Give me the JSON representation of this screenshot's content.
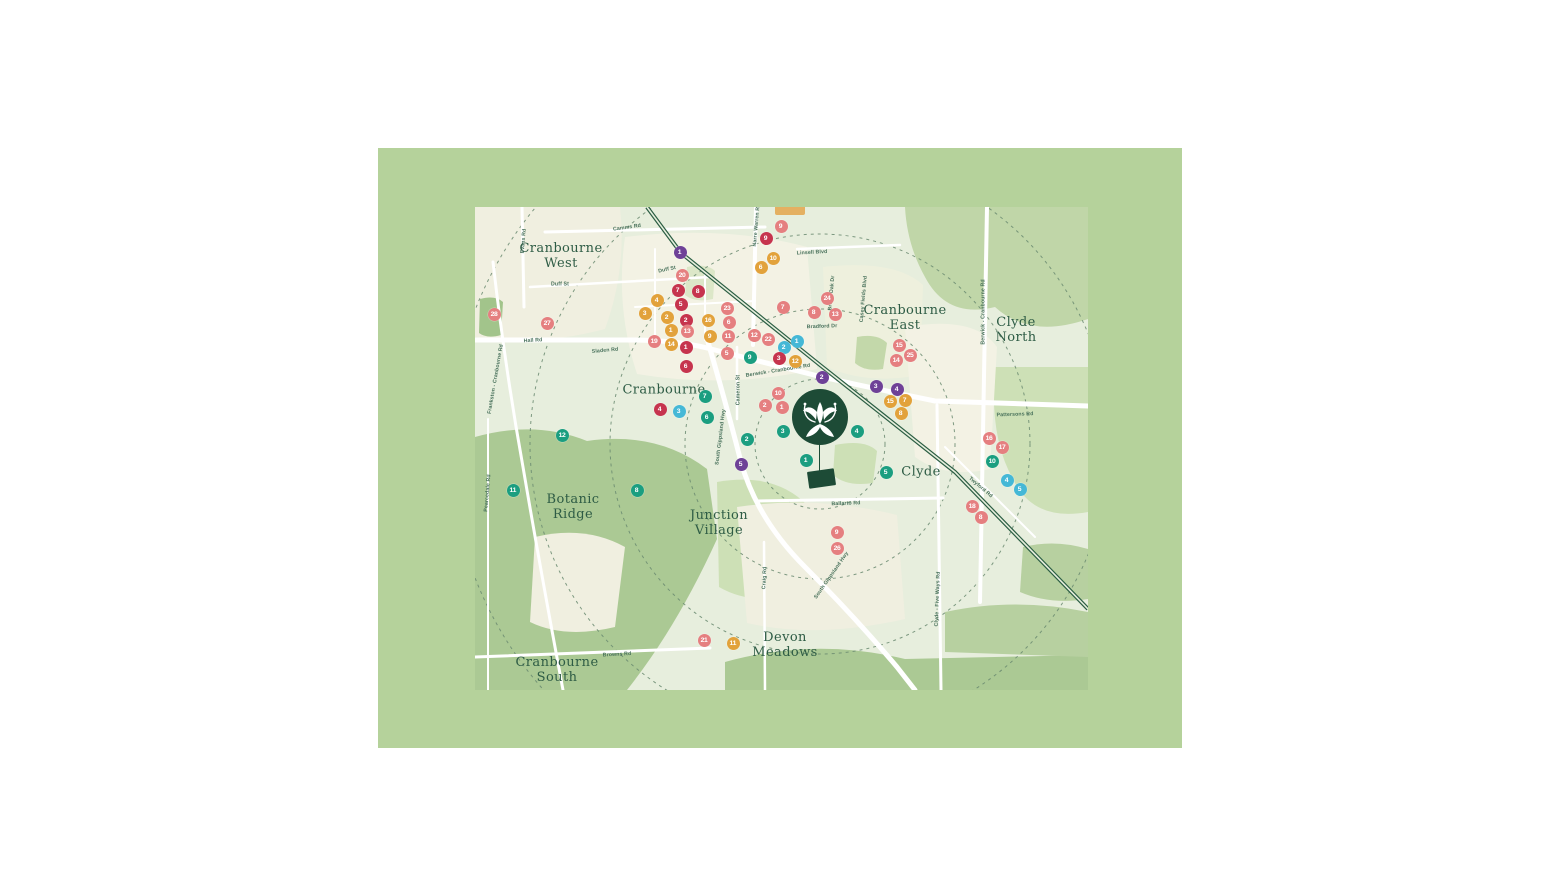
{
  "map": {
    "palette": {
      "band_green": "#b5d29b",
      "map_base": "#e7eedd",
      "urban_cream": "#f3f2e4",
      "sage": "#c9dcb4",
      "park_green": "#abc994",
      "road_white": "#ffffff",
      "railway_green": "#2b5e43",
      "ring_dash": "#6a8a70",
      "label_green": "#2e5c45",
      "estate_dark_green": "#1d4b36",
      "marker_red": "#c6344e",
      "marker_salmon": "#e57f80",
      "marker_orange": "#e2a23b",
      "marker_teal": "#1b9e80",
      "marker_cyan": "#45b8d6",
      "marker_purple": "#6e4197"
    },
    "suburbs": [
      {
        "label": "Cranbourne\nWest",
        "x": 86,
        "y": 50
      },
      {
        "label": "Cranbourne",
        "x": 189,
        "y": 184
      },
      {
        "label": "Cranbourne\nEast",
        "x": 430,
        "y": 112
      },
      {
        "label": "Clyde\nNorth",
        "x": 541,
        "y": 124
      },
      {
        "label": "Botanic\nRidge",
        "x": 98,
        "y": 301
      },
      {
        "label": "Junction\nVillage",
        "x": 244,
        "y": 317
      },
      {
        "label": "Devon\nMeadows",
        "x": 310,
        "y": 439
      },
      {
        "label": "Cranbourne\nSouth",
        "x": 82,
        "y": 464
      },
      {
        "label": "Clyde",
        "x": 446,
        "y": 266
      }
    ],
    "road_labels": [
      {
        "name": "Camms Rd",
        "x": 152,
        "y": 20,
        "rot": -8
      },
      {
        "name": "Duff St",
        "x": 85,
        "y": 77,
        "rot": 0
      },
      {
        "name": "Duff St",
        "x": 192,
        "y": 62,
        "rot": -12
      },
      {
        "name": "Hall Rd",
        "x": 58,
        "y": 133,
        "rot": -3
      },
      {
        "name": "Sladen Rd",
        "x": 130,
        "y": 143,
        "rot": -5
      },
      {
        "name": "Berwick - Cranbourne Rd",
        "x": 303,
        "y": 163,
        "rot": -9
      },
      {
        "name": "Cameron St",
        "x": 263,
        "y": 183,
        "rot": -90
      },
      {
        "name": "South Gippsland Hwy",
        "x": 245,
        "y": 230,
        "rot": -83
      },
      {
        "name": "South Gippsland Hwy",
        "x": 356,
        "y": 368,
        "rot": -55
      },
      {
        "name": "Ballarto Rd",
        "x": 371,
        "y": 296,
        "rot": -2
      },
      {
        "name": "Craig Rd",
        "x": 289,
        "y": 371,
        "rot": -87
      },
      {
        "name": "Browns Rd",
        "x": 142,
        "y": 447,
        "rot": -3
      },
      {
        "name": "Pattersons Rd",
        "x": 540,
        "y": 207,
        "rot": -2
      },
      {
        "name": "Twyford Rd",
        "x": 506,
        "y": 280,
        "rot": 40
      },
      {
        "name": "Pearcedale Rd",
        "x": 12,
        "y": 286,
        "rot": -85
      },
      {
        "name": "Frankston - Cranbourne Rd",
        "x": 20,
        "y": 172,
        "rot": -80
      },
      {
        "name": "Evans Rd",
        "x": 48,
        "y": 34,
        "rot": -85
      },
      {
        "name": "Narre Warren Rd",
        "x": 281,
        "y": 18,
        "rot": -85
      },
      {
        "name": "Linsell Blvd",
        "x": 337,
        "y": 45,
        "rot": -3
      },
      {
        "name": "Broad Oak Dr",
        "x": 356,
        "y": 86,
        "rot": -85
      },
      {
        "name": "Casey Fields Blvd",
        "x": 388,
        "y": 92,
        "rot": -85
      },
      {
        "name": "Bradford Dr",
        "x": 347,
        "y": 119,
        "rot": -2
      },
      {
        "name": "Clyde - Five Ways Rd",
        "x": 462,
        "y": 392,
        "rot": -88
      },
      {
        "name": "Berwick - Cranbourne Rd",
        "x": 508,
        "y": 105,
        "rot": -90
      }
    ],
    "markers": {
      "items": [
        {
          "n": "1",
          "color": "marker_purple",
          "x": 205,
          "y": 45
        },
        {
          "n": "2",
          "color": "marker_purple",
          "x": 347,
          "y": 170
        },
        {
          "n": "3",
          "color": "marker_purple",
          "x": 401,
          "y": 179
        },
        {
          "n": "4",
          "color": "marker_purple",
          "x": 422,
          "y": 182
        },
        {
          "n": "5",
          "color": "marker_purple",
          "x": 266,
          "y": 257
        },
        {
          "n": "1",
          "color": "marker_cyan",
          "x": 322,
          "y": 134
        },
        {
          "n": "2",
          "color": "marker_cyan",
          "x": 309,
          "y": 140
        },
        {
          "n": "3",
          "color": "marker_cyan",
          "x": 204,
          "y": 204
        },
        {
          "n": "4",
          "color": "marker_cyan",
          "x": 532,
          "y": 273
        },
        {
          "n": "5",
          "color": "marker_cyan",
          "x": 545,
          "y": 282
        },
        {
          "n": "1",
          "color": "marker_teal",
          "x": 331,
          "y": 253
        },
        {
          "n": "2",
          "color": "marker_teal",
          "x": 272,
          "y": 232
        },
        {
          "n": "3",
          "color": "marker_teal",
          "x": 308,
          "y": 224
        },
        {
          "n": "4",
          "color": "marker_teal",
          "x": 382,
          "y": 224
        },
        {
          "n": "5",
          "color": "marker_teal",
          "x": 411,
          "y": 265
        },
        {
          "n": "6",
          "color": "marker_teal",
          "x": 232,
          "y": 210
        },
        {
          "n": "7",
          "color": "marker_teal",
          "x": 230,
          "y": 189
        },
        {
          "n": "8",
          "color": "marker_teal",
          "x": 162,
          "y": 283
        },
        {
          "n": "9",
          "color": "marker_teal",
          "x": 275,
          "y": 150
        },
        {
          "n": "10",
          "color": "marker_teal",
          "x": 517,
          "y": 254
        },
        {
          "n": "11",
          "color": "marker_teal",
          "x": 38,
          "y": 283
        },
        {
          "n": "12",
          "color": "marker_teal",
          "x": 87,
          "y": 228
        },
        {
          "n": "1",
          "color": "marker_red",
          "x": 211,
          "y": 140
        },
        {
          "n": "2",
          "color": "marker_red",
          "x": 211,
          "y": 113
        },
        {
          "n": "3",
          "color": "marker_red",
          "x": 304,
          "y": 151
        },
        {
          "n": "4",
          "color": "marker_red",
          "x": 185,
          "y": 202
        },
        {
          "n": "5",
          "color": "marker_red",
          "x": 206,
          "y": 97
        },
        {
          "n": "6",
          "color": "marker_red",
          "x": 211,
          "y": 159
        },
        {
          "n": "7",
          "color": "marker_red",
          "x": 203,
          "y": 83
        },
        {
          "n": "8",
          "color": "marker_red",
          "x": 223,
          "y": 84
        },
        {
          "n": "9",
          "color": "marker_red",
          "x": 291,
          "y": 31
        },
        {
          "n": "1",
          "color": "marker_orange",
          "x": 196,
          "y": 123
        },
        {
          "n": "2",
          "color": "marker_orange",
          "x": 192,
          "y": 110
        },
        {
          "n": "3",
          "color": "marker_orange",
          "x": 170,
          "y": 106
        },
        {
          "n": "4",
          "color": "marker_orange",
          "x": 182,
          "y": 93
        },
        {
          "n": "6",
          "color": "marker_orange",
          "x": 286,
          "y": 60
        },
        {
          "n": "7",
          "color": "marker_orange",
          "x": 430,
          "y": 193
        },
        {
          "n": "8",
          "color": "marker_orange",
          "x": 426,
          "y": 206
        },
        {
          "n": "9",
          "color": "marker_orange",
          "x": 235,
          "y": 129
        },
        {
          "n": "10",
          "color": "marker_orange",
          "x": 298,
          "y": 51
        },
        {
          "n": "11",
          "color": "marker_orange",
          "x": 258,
          "y": 436
        },
        {
          "n": "12",
          "color": "marker_orange",
          "x": 320,
          "y": 154
        },
        {
          "n": "14",
          "color": "marker_orange",
          "x": 196,
          "y": 137
        },
        {
          "n": "15",
          "color": "marker_orange",
          "x": 415,
          "y": 194
        },
        {
          "n": "16",
          "color": "marker_orange",
          "x": 233,
          "y": 113
        },
        {
          "n": "1",
          "color": "marker_salmon",
          "x": 307,
          "y": 200
        },
        {
          "n": "2",
          "color": "marker_salmon",
          "x": 290,
          "y": 198
        },
        {
          "n": "5",
          "color": "marker_salmon",
          "x": 252,
          "y": 146
        },
        {
          "n": "6",
          "color": "marker_salmon",
          "x": 254,
          "y": 115
        },
        {
          "n": "7",
          "color": "marker_salmon",
          "x": 308,
          "y": 100
        },
        {
          "n": "8",
          "color": "marker_salmon",
          "x": 339,
          "y": 105
        },
        {
          "n": "8",
          "color": "marker_salmon",
          "x": 506,
          "y": 310
        },
        {
          "n": "9",
          "color": "marker_salmon",
          "x": 306,
          "y": 19
        },
        {
          "n": "9",
          "color": "marker_salmon",
          "x": 362,
          "y": 325
        },
        {
          "n": "10",
          "color": "marker_salmon",
          "x": 303,
          "y": 186
        },
        {
          "n": "11",
          "color": "marker_salmon",
          "x": 253,
          "y": 129
        },
        {
          "n": "12",
          "color": "marker_salmon",
          "x": 279,
          "y": 128
        },
        {
          "n": "13",
          "color": "marker_salmon",
          "x": 212,
          "y": 124
        },
        {
          "n": "13",
          "color": "marker_salmon",
          "x": 360,
          "y": 107
        },
        {
          "n": "14",
          "color": "marker_salmon",
          "x": 421,
          "y": 153
        },
        {
          "n": "15",
          "color": "marker_salmon",
          "x": 424,
          "y": 138
        },
        {
          "n": "16",
          "color": "marker_salmon",
          "x": 514,
          "y": 231
        },
        {
          "n": "17",
          "color": "marker_salmon",
          "x": 527,
          "y": 240
        },
        {
          "n": "18",
          "color": "marker_salmon",
          "x": 497,
          "y": 299
        },
        {
          "n": "19",
          "color": "marker_salmon",
          "x": 179,
          "y": 134
        },
        {
          "n": "20",
          "color": "marker_salmon",
          "x": 207,
          "y": 68
        },
        {
          "n": "21",
          "color": "marker_salmon",
          "x": 229,
          "y": 433
        },
        {
          "n": "22",
          "color": "marker_salmon",
          "x": 293,
          "y": 132
        },
        {
          "n": "23",
          "color": "marker_salmon",
          "x": 252,
          "y": 101
        },
        {
          "n": "24",
          "color": "marker_salmon",
          "x": 352,
          "y": 91
        },
        {
          "n": "25",
          "color": "marker_salmon",
          "x": 435,
          "y": 148
        },
        {
          "n": "26",
          "color": "marker_salmon",
          "x": 362,
          "y": 341
        },
        {
          "n": "27",
          "color": "marker_salmon",
          "x": 72,
          "y": 116
        },
        {
          "n": "28",
          "color": "marker_salmon",
          "x": 19,
          "y": 107
        }
      ]
    }
  }
}
